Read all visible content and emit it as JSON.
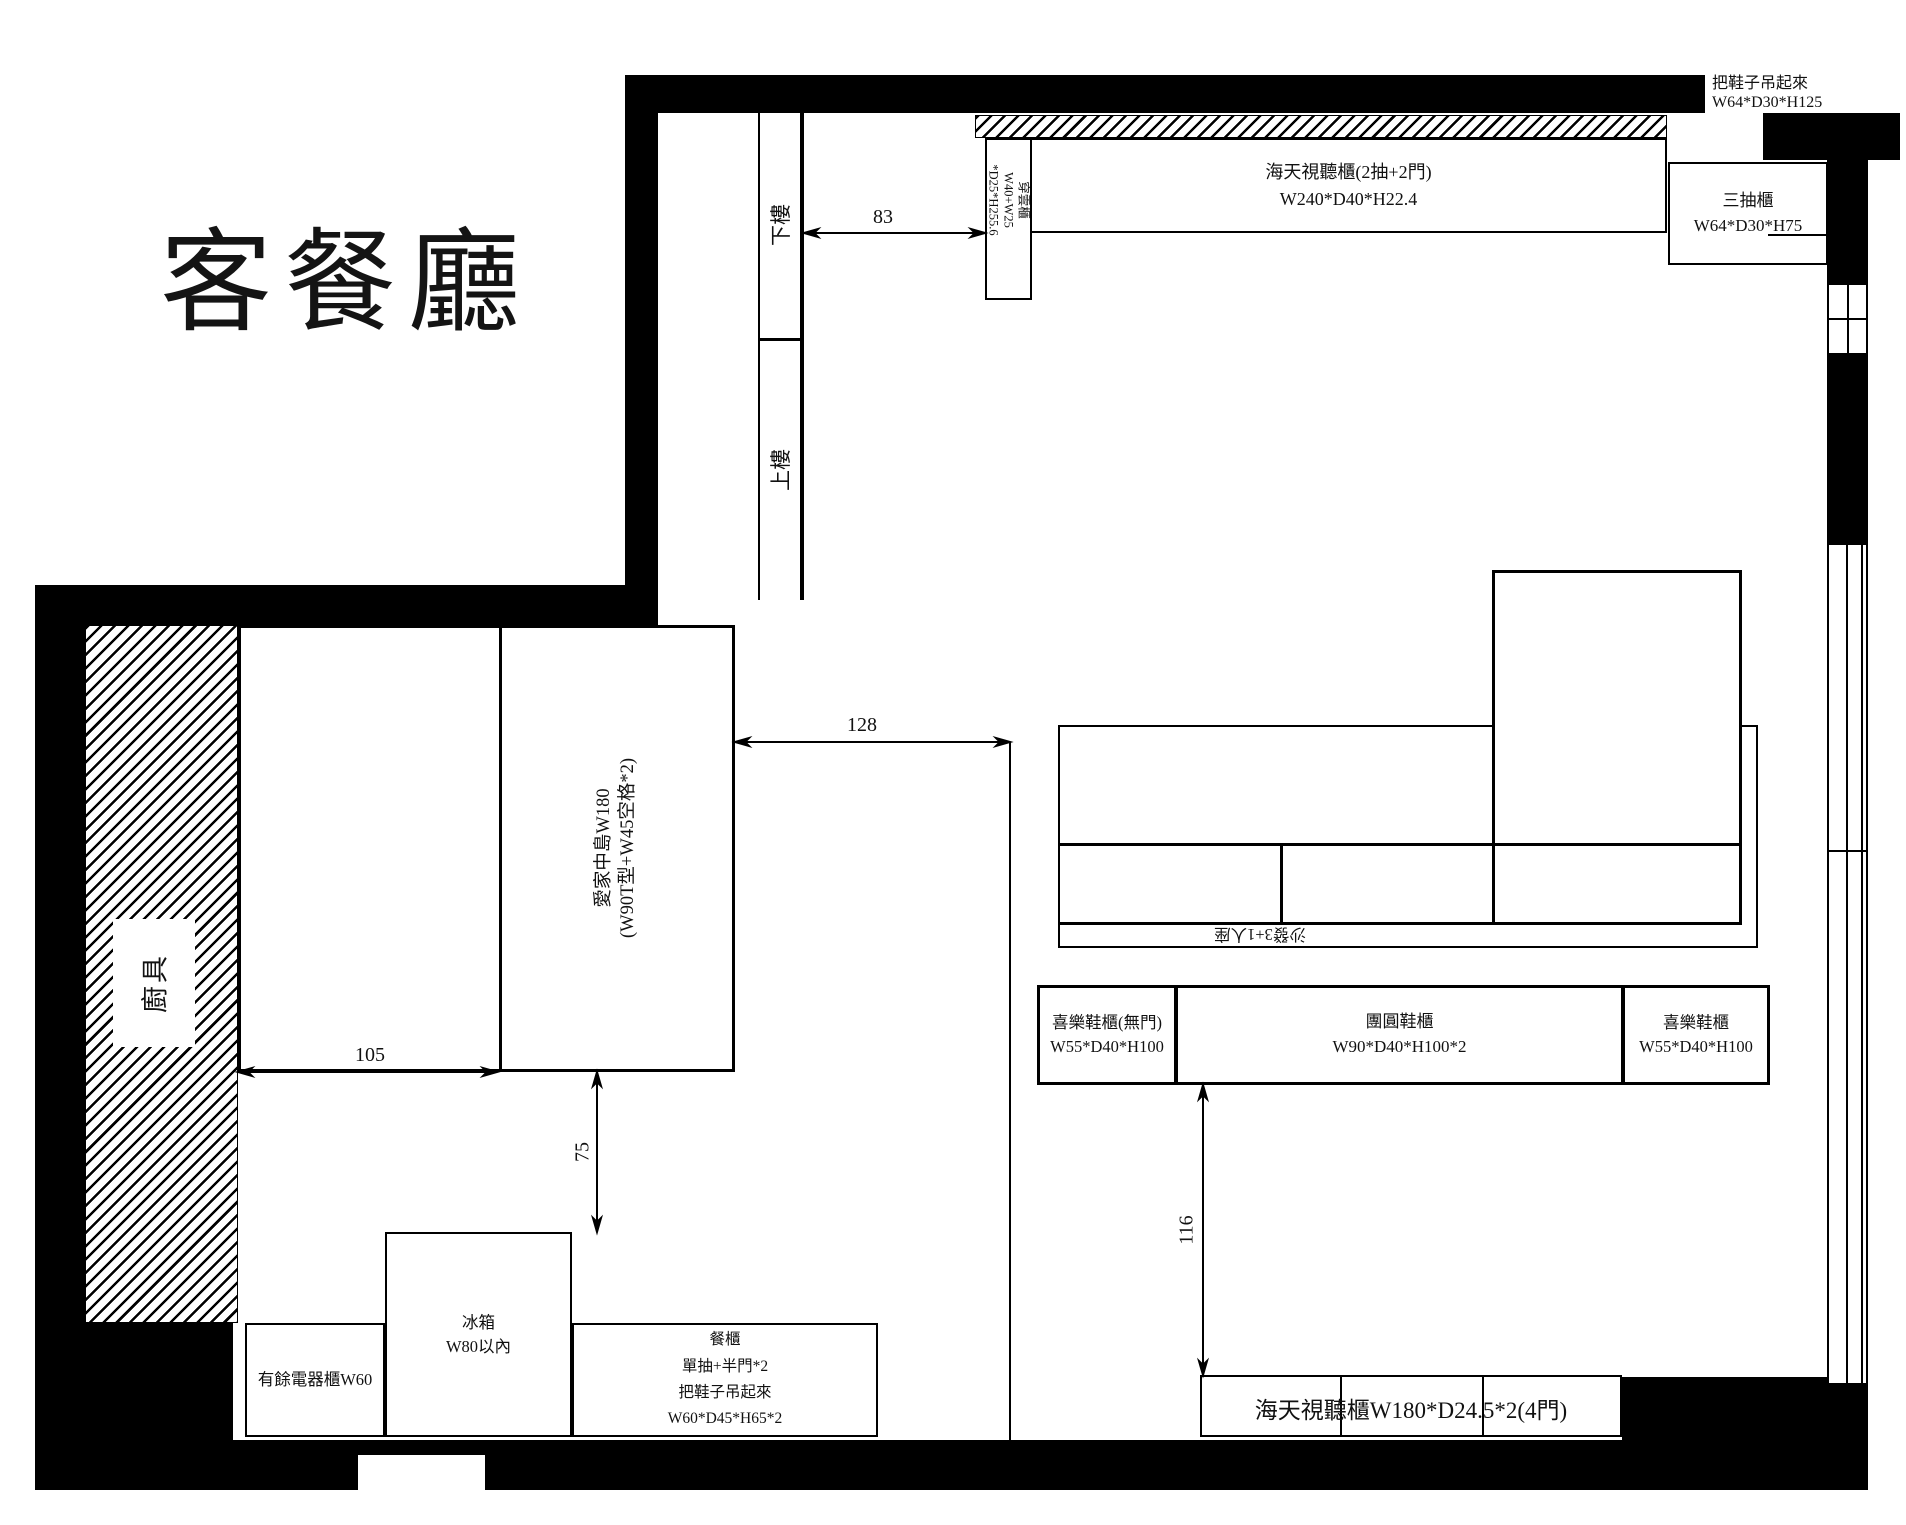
{
  "title": "客餐廳",
  "colors": {
    "line": "#000000",
    "background": "#ffffff"
  },
  "notes": {
    "hang_shoes_top": {
      "line1": "把鞋子吊起來",
      "line2": "W64*D30*H125"
    }
  },
  "stairs": {
    "down": "下樓",
    "up": "上樓"
  },
  "kitchen": {
    "label": "廚具"
  },
  "furniture": {
    "av_cabinet_top": {
      "line1": "海天視聽櫃(2抽+2門)",
      "line2": "W240*D40*H22.4"
    },
    "three_drawer_cabinet": {
      "line1": "三抽櫃",
      "line2": "W64*D30*H75"
    },
    "chuanyun_cabinet": {
      "line1": "穿雲櫃",
      "line2": "W40+W25",
      "line3": "*D25*H255.6"
    },
    "island": {
      "line1": "愛家中島W180",
      "line2": "(W90T型+W45空格*2)"
    },
    "sofa": {
      "label": "沙發3+1人座"
    },
    "shoe_cabinet_left": {
      "line1": "喜樂鞋櫃(無門)",
      "line2": "W55*D40*H100"
    },
    "shoe_cabinet_mid": {
      "line1": "團圓鞋櫃",
      "line2": "W90*D40*H100*2"
    },
    "shoe_cabinet_right": {
      "line1": "喜樂鞋櫃",
      "line2": "W55*D40*H100"
    },
    "av_cabinet_bottom": {
      "label": "海天視聽櫃W180*D24.5*2(4門)"
    },
    "appliance_cabinet": {
      "label": "有餘電器櫃W60"
    },
    "fridge": {
      "line1": "冰箱",
      "line2": "W80以內"
    },
    "sideboard": {
      "line1": "餐櫃",
      "line2": "單抽+半門*2",
      "line3": "把鞋子吊起來",
      "line4": "W60*D45*H65*2"
    }
  },
  "dimensions": {
    "d83": "83",
    "d128": "128",
    "d105": "105",
    "d75": "75",
    "d116": "116"
  }
}
